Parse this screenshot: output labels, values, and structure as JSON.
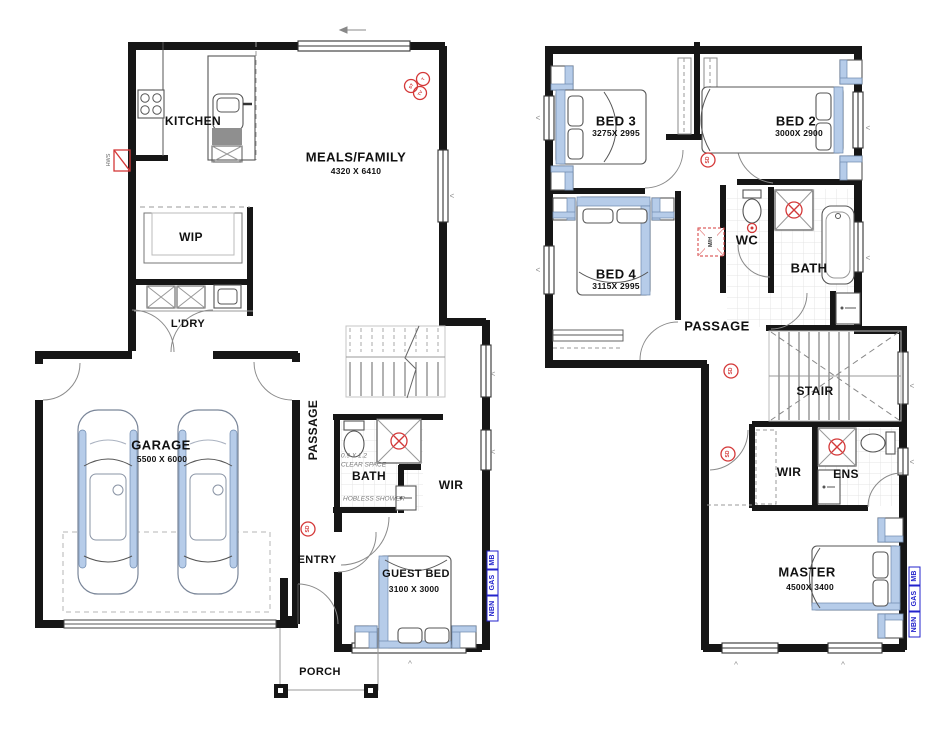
{
  "gf": {
    "kitchen": {
      "label": "KITCHEN"
    },
    "meals": {
      "label": "MEALS/FAMILY",
      "dims": "4320 X 6410"
    },
    "wip": {
      "label": "WIP"
    },
    "ldry": {
      "label": "L'DRY"
    },
    "garage": {
      "label": "GARAGE",
      "dims": "5500 X 6000"
    },
    "passage": {
      "label": "PASSAGE"
    },
    "entry": {
      "label": "ENTRY"
    },
    "bath": {
      "label": "BATH"
    },
    "wir": {
      "label": "WIR"
    },
    "guest": {
      "label": "GUEST BED",
      "dims": "3100 X 3000"
    },
    "porch": {
      "label": "PORCH"
    },
    "notes": {
      "clear_dims": "0.9 X 1.2",
      "clear": "CLEAR SPACE",
      "shower": "HOBLESS SHOWER"
    }
  },
  "uf": {
    "bed3": {
      "label": "BED 3",
      "dims": "3275X 2995"
    },
    "bed2": {
      "label": "BED 2",
      "dims": "3000X 2900"
    },
    "bed4": {
      "label": "BED 4",
      "dims": "3115X 2995"
    },
    "wc": {
      "label": "WC"
    },
    "bath": {
      "label": "BATH"
    },
    "passage": {
      "label": "PASSAGE"
    },
    "stair": {
      "label": "STAIR"
    },
    "wir": {
      "label": "WIR"
    },
    "ens": {
      "label": "ENS"
    },
    "master": {
      "label": "MASTER",
      "dims": "4500X 3400"
    }
  },
  "symbols": {
    "sd": "SD",
    "hws": "HWS",
    "mh": "M/H",
    "tv": "TV",
    "t": "T",
    "st": "ST"
  },
  "services": {
    "nbn": "NBN",
    "gas": "GAS",
    "mb": "MB"
  },
  "colors": {
    "wall": "#161616",
    "accent_blue": "#b6cce9",
    "symbol_red": "#d43838",
    "service_blue": "#2323cc"
  }
}
